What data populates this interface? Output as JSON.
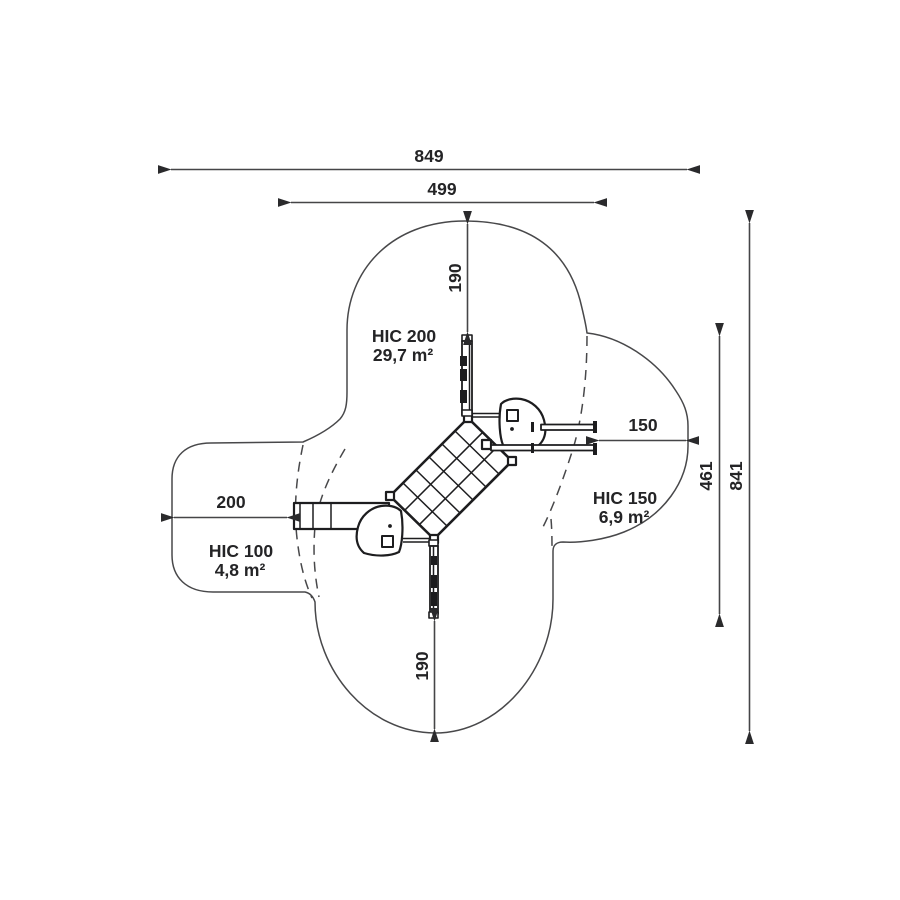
{
  "diagram": {
    "title": "playground-unit-plan-view-with-safety-zones",
    "dims": {
      "total_width": "849",
      "inner_width": "499",
      "total_height": "841",
      "right_height": "461",
      "top_offset": "190",
      "bottom_offset": "190",
      "left_offset": "200",
      "right_offset": "150"
    },
    "zones": {
      "hic200": {
        "name": "HIC 200",
        "area": "29,7 m²"
      },
      "hic150": {
        "name": "HIC 150",
        "area": "6,9 m²"
      },
      "hic100": {
        "name": "HIC 100",
        "area": "4,8 m²"
      }
    },
    "colors": {
      "line": "#48484a",
      "structure": "#1d1d1f",
      "text": "#242426",
      "background": "#ffffff"
    }
  }
}
